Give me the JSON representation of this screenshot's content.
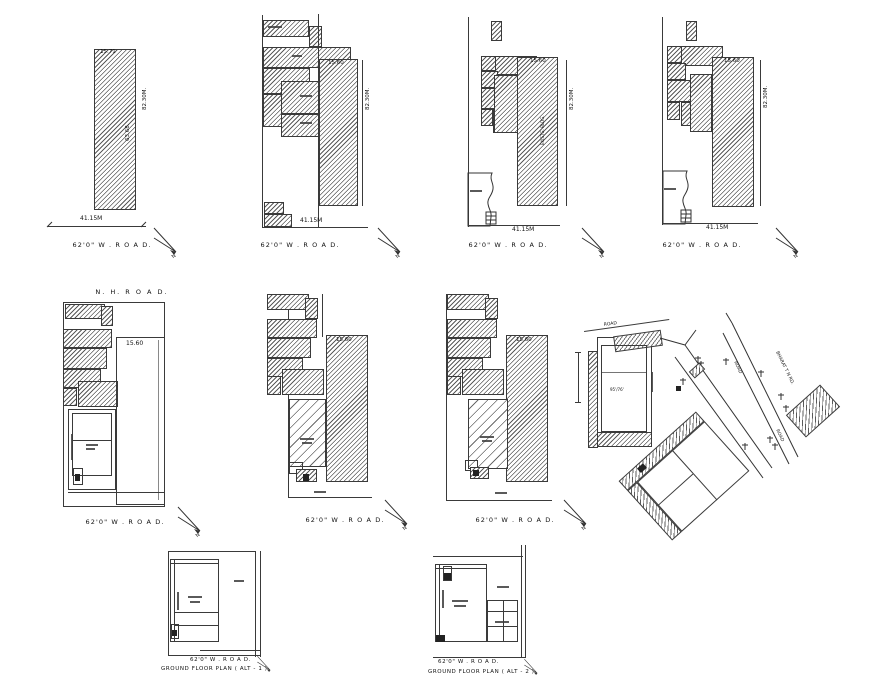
{
  "sheet": {
    "background": "#ffffff",
    "ink": "#3a3a3a"
  },
  "labels": {
    "road_62": "62'0\" W . R O A D.",
    "nh_road": "N. H. R O  A D.",
    "north": "N"
  },
  "row1": {
    "site1": {
      "width_top": "15.71",
      "depth_side": "82.30M.",
      "inner_depth": "63.68.",
      "frontage": "41.15M"
    },
    "site2": {
      "width_top": "15.60",
      "depth_side": "82.30M.",
      "frontage": "41.15M"
    },
    "site3": {
      "width_top": "15.60",
      "depth_side": "82.30M.",
      "frontage": "41.15M",
      "building": "EXISTG. BLDG."
    },
    "site4": {
      "width_top": "15.60",
      "depth_side": "82.30M.",
      "frontage": "41.15M"
    }
  },
  "row2": {
    "site5": {
      "width": "15.60"
    },
    "site6": {
      "width": "15.60"
    },
    "site7": {
      "width": "15.60"
    },
    "site8": {
      "road_small": "ROAD",
      "road_a": "ROAD",
      "road_b": "ROAD",
      "highway": "BHARAT T N RD.",
      "plot_dim": "95'/76'"
    }
  },
  "row3": {
    "alt1": {
      "caption": "GROUND FLOOR PLAN ( ALT - 1 )"
    },
    "alt2": {
      "caption": "GROUND FLOOR PLAN ( ALT - 2 )"
    }
  }
}
